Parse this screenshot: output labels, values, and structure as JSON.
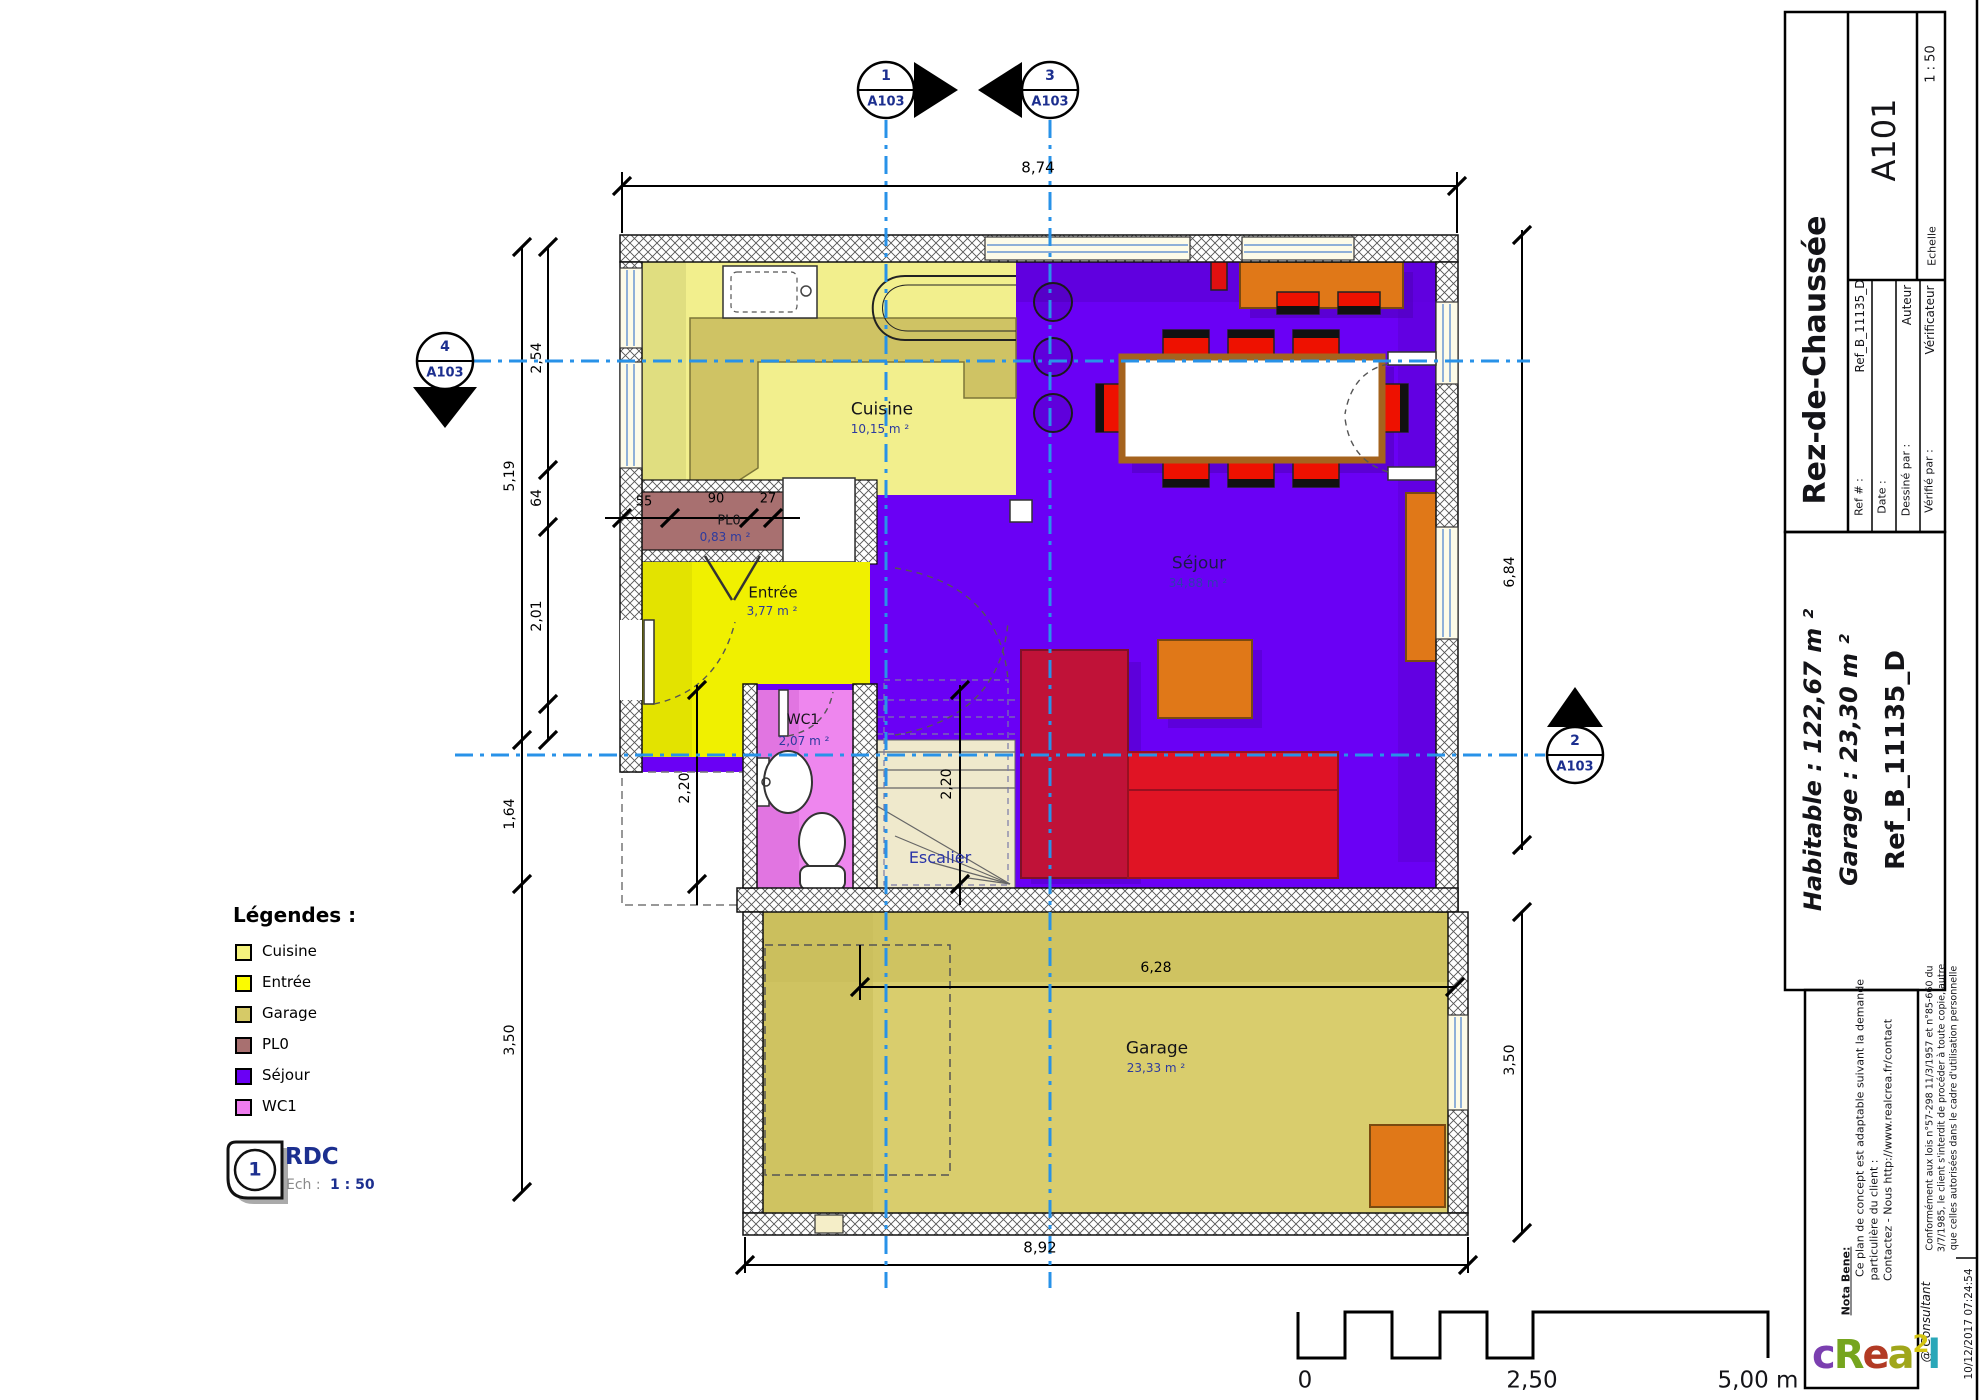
{
  "titleblock": {
    "sheet_number": "A101",
    "floor_title": "Rez-de-Chaussée",
    "scale_label": "Echelle",
    "scale_value": "1 : 50",
    "ref_label": "Ref # :",
    "ref_value": "Ref_B_11135_D",
    "date_label": "Date :",
    "drawn_label": "Dessiné par :",
    "drawn_value": "Auteur",
    "checked_label": "Vérifié par :",
    "checked_value": "Vérificateur",
    "habitable": "Habitable : 122,67 m ²",
    "garage": "Garage : 23,30 m ²",
    "ref_big": "Ref_B_11135_D"
  },
  "rooms": {
    "cuisine": {
      "name": "Cuisine",
      "area": "10,15 m ²"
    },
    "sejour": {
      "name": "Séjour",
      "area": "34,88 m ²"
    },
    "entree": {
      "name": "Entrée",
      "area": "3,77 m ²"
    },
    "wc1": {
      "name": "WC1",
      "area": "2,07 m ²"
    },
    "pl0": {
      "name": "PL0",
      "area": "0,83 m ²"
    },
    "escalier": {
      "name": "Escalier"
    },
    "garage": {
      "name": "Garage",
      "area": "23,33 m ²"
    }
  },
  "dims": {
    "top": "8,74",
    "bottom": "8,92",
    "right_main": "6,84",
    "right_garage": "3,50",
    "left_total": "5,19",
    "left_lower": "1,64",
    "left_garage": "3,50",
    "left_a": "2,54",
    "left_b": "64",
    "left_c": "2,01",
    "hall_depth": "2,20",
    "stair_depth": "2,20",
    "garage_width": "6,28",
    "pl0_a": "55",
    "pl0_b": "90",
    "pl0_c": "27"
  },
  "markers": {
    "m1": {
      "num": "1",
      "sheet": "A103"
    },
    "m2": {
      "num": "2",
      "sheet": "A103"
    },
    "m3": {
      "num": "3",
      "sheet": "A103"
    },
    "m4": {
      "num": "4",
      "sheet": "A103"
    }
  },
  "legend": {
    "title": "Légendes :",
    "items": [
      {
        "label": "Cuisine",
        "color": "#f5f37d"
      },
      {
        "label": "Entrée",
        "color": "#fbfb00"
      },
      {
        "label": "Garage",
        "color": "#d6ca67"
      },
      {
        "label": "PL0",
        "color": "#a87070"
      },
      {
        "label": "Séjour",
        "color": "#6a00f5"
      },
      {
        "label": "WC1",
        "color": "#ee7cee"
      }
    ]
  },
  "stamp": {
    "number": "1",
    "title": "RDC",
    "scale_label": "Ech :",
    "scale_value": "1 : 50"
  },
  "scalebar": {
    "zero": "0",
    "mid": "2,50",
    "end": "5,00 m"
  },
  "notes": {
    "nota": "Nota Bene:",
    "line1": "Ce plan de concept est adaptable suivant la demande",
    "line2": "particulière du client :",
    "line3": "Contactez - Nous http://www.realcrea.fr/contact",
    "consultant": "@ Consultant",
    "legal1": "Conformément aux lois n°57-298 11/3/1957 et n°85-660 du",
    "legal2": "3/7/1985, le client s'interdit de procéder à toute copie, autre",
    "legal3": "que celles autorisées dans le cadre d'utilisation personnelle",
    "timestamp": "10/12/2017 07:24:54"
  },
  "logo": {
    "letters": [
      {
        "t": "c",
        "c": "#7b3fb0"
      },
      {
        "t": "R",
        "c": "#76a51e"
      },
      {
        "t": "e",
        "c": "#b23a24"
      },
      {
        "t": "a",
        "c": "#a0a61a"
      },
      {
        "t": "2",
        "c": "#d4c410"
      },
      {
        "t": "l",
        "c": "#2aa7b8"
      }
    ]
  }
}
